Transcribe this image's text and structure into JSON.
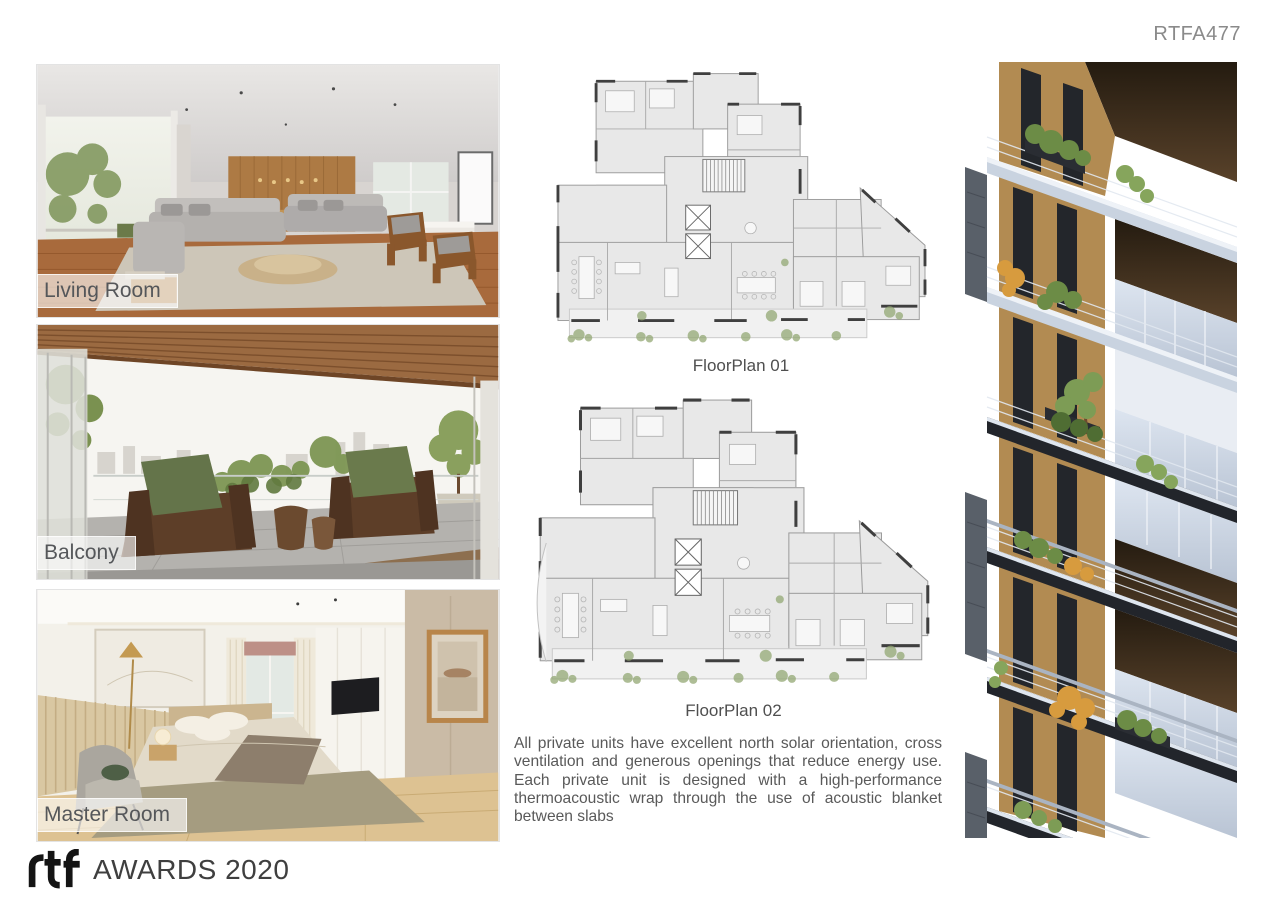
{
  "page": {
    "code": "RTFA477"
  },
  "photos": [
    {
      "label": "Living Room"
    },
    {
      "label": "Balcony"
    },
    {
      "label": "Master Room"
    }
  ],
  "floorplans": [
    {
      "caption": "FloorPlan 01"
    },
    {
      "caption": "FloorPlan 02"
    }
  ],
  "description": "All private units have excellent north solar orientation, cross ventilation and generous openings that reduce energy use. Each private unit is designed with a high-performance thermoacoustic wrap through the use of acoustic blanket between slabs",
  "footer": {
    "logo": "rtf",
    "label": "AWARDS 2020"
  },
  "colors": {
    "text_gray": "#595959",
    "label_gray": "#55575a",
    "plan_fill": "#e8e8e8",
    "facade_ochre": "#b28b52",
    "facade_green": "#6c8c46",
    "facade_orange": "#d79b3e"
  }
}
